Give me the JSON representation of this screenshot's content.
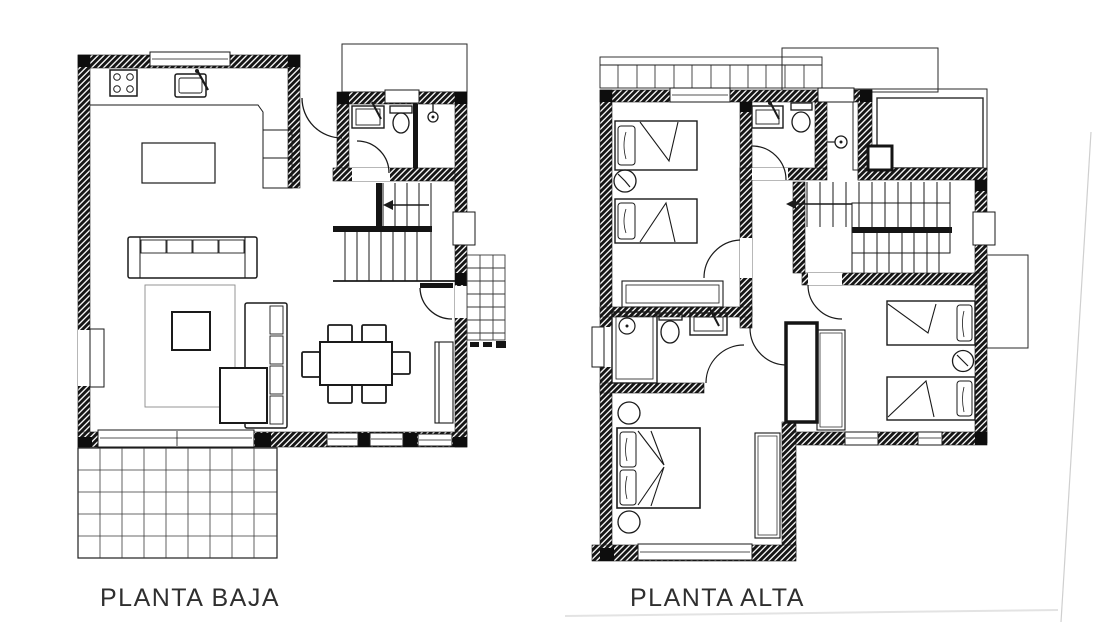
{
  "background": "#ffffff",
  "ink_color": "#1a1a1a",
  "label_color": "#2f2f2f",
  "faint_edge_color": "#cfcfcf",
  "plans": [
    {
      "id": "planta-baja",
      "label": "PLANTA BAJA",
      "rooms": [
        "kitchen-living-dining",
        "bathroom",
        "staircase",
        "entry-hall",
        "terrace",
        "entry-porch"
      ],
      "fixtures": [
        "cooktop",
        "kitchen-sink",
        "kitchen-counter",
        "kitchen-island",
        "sofa",
        "chaise-sofa",
        "rug",
        "coffee-table",
        "ottoman-table",
        "dining-table",
        "dining-chairs",
        "sideboard",
        "washbasin",
        "toilet",
        "shower",
        "stairs-direction-arrow",
        "entrance-door",
        "terrace-paving-grid",
        "porch-paving-grid"
      ]
    },
    {
      "id": "planta-alta",
      "label": "PLANTA ALTA",
      "rooms": [
        "twin-bedroom-left",
        "bathroom-top",
        "shower-room",
        "hallway",
        "staircase",
        "roof-terrace",
        "master-bedroom",
        "bathroom-left",
        "twin-bedroom-right",
        "balcony"
      ],
      "fixtures": [
        "single-bed",
        "single-bed",
        "nightstand",
        "wardrobe",
        "washbasin",
        "toilet",
        "shower-head",
        "shower-stall",
        "stairs-direction-arrow",
        "double-bed",
        "round-side-table",
        "round-side-table",
        "closet",
        "wardrobe",
        "single-bed",
        "single-bed",
        "nightstand",
        "balcony-railing-grid"
      ]
    }
  ]
}
